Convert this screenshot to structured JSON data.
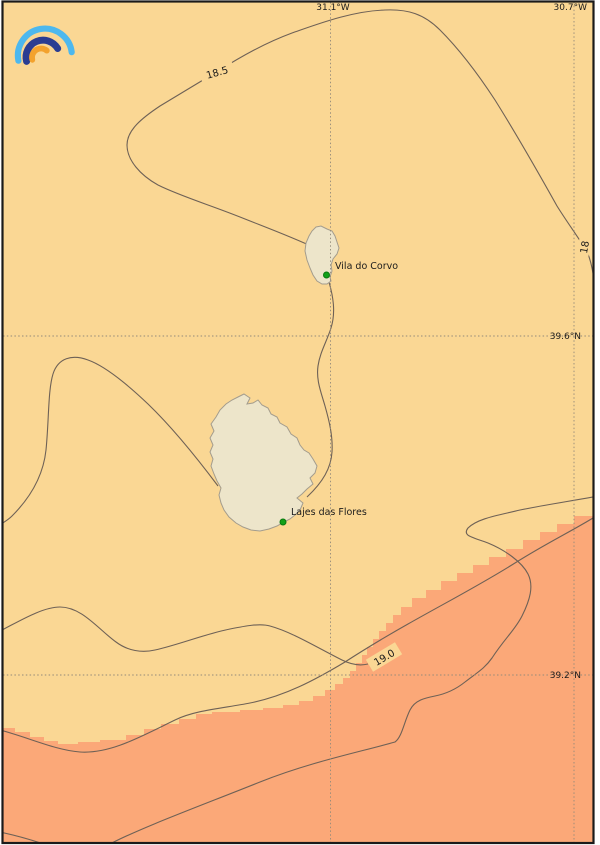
{
  "branding": {
    "logo": "rainbow-arcs-logo"
  },
  "grid": {
    "lon_left": "31.1°W",
    "lon_right": "30.7°W",
    "lat_upper": "39.6°N",
    "lat_lower": "39.2°N"
  },
  "isotherms": {
    "label_18_5": "18.5",
    "label_18": "18",
    "label_19_0": "19.0"
  },
  "places": {
    "corvo_town": "Vila do Corvo",
    "flores_town": "Lajes das Flores"
  },
  "colors": {
    "sea_cool": "#FAD794",
    "sea_warm": "#FBA878",
    "land": "#EDE5CA",
    "land_outline": "#A39C8D",
    "contour": "#6E6156",
    "grid_line": "#938A7A",
    "town_marker": "#12A118",
    "town_marker_edge": "#0A7A10",
    "label_text": "#1B1B1B",
    "frame": "#1A1A1A",
    "page_background": "#FFFFFF",
    "logo_outer_arc": "#4DB8EE",
    "logo_middle_arc": "#2A3D92",
    "logo_inner_arc": "#F3A22D"
  }
}
